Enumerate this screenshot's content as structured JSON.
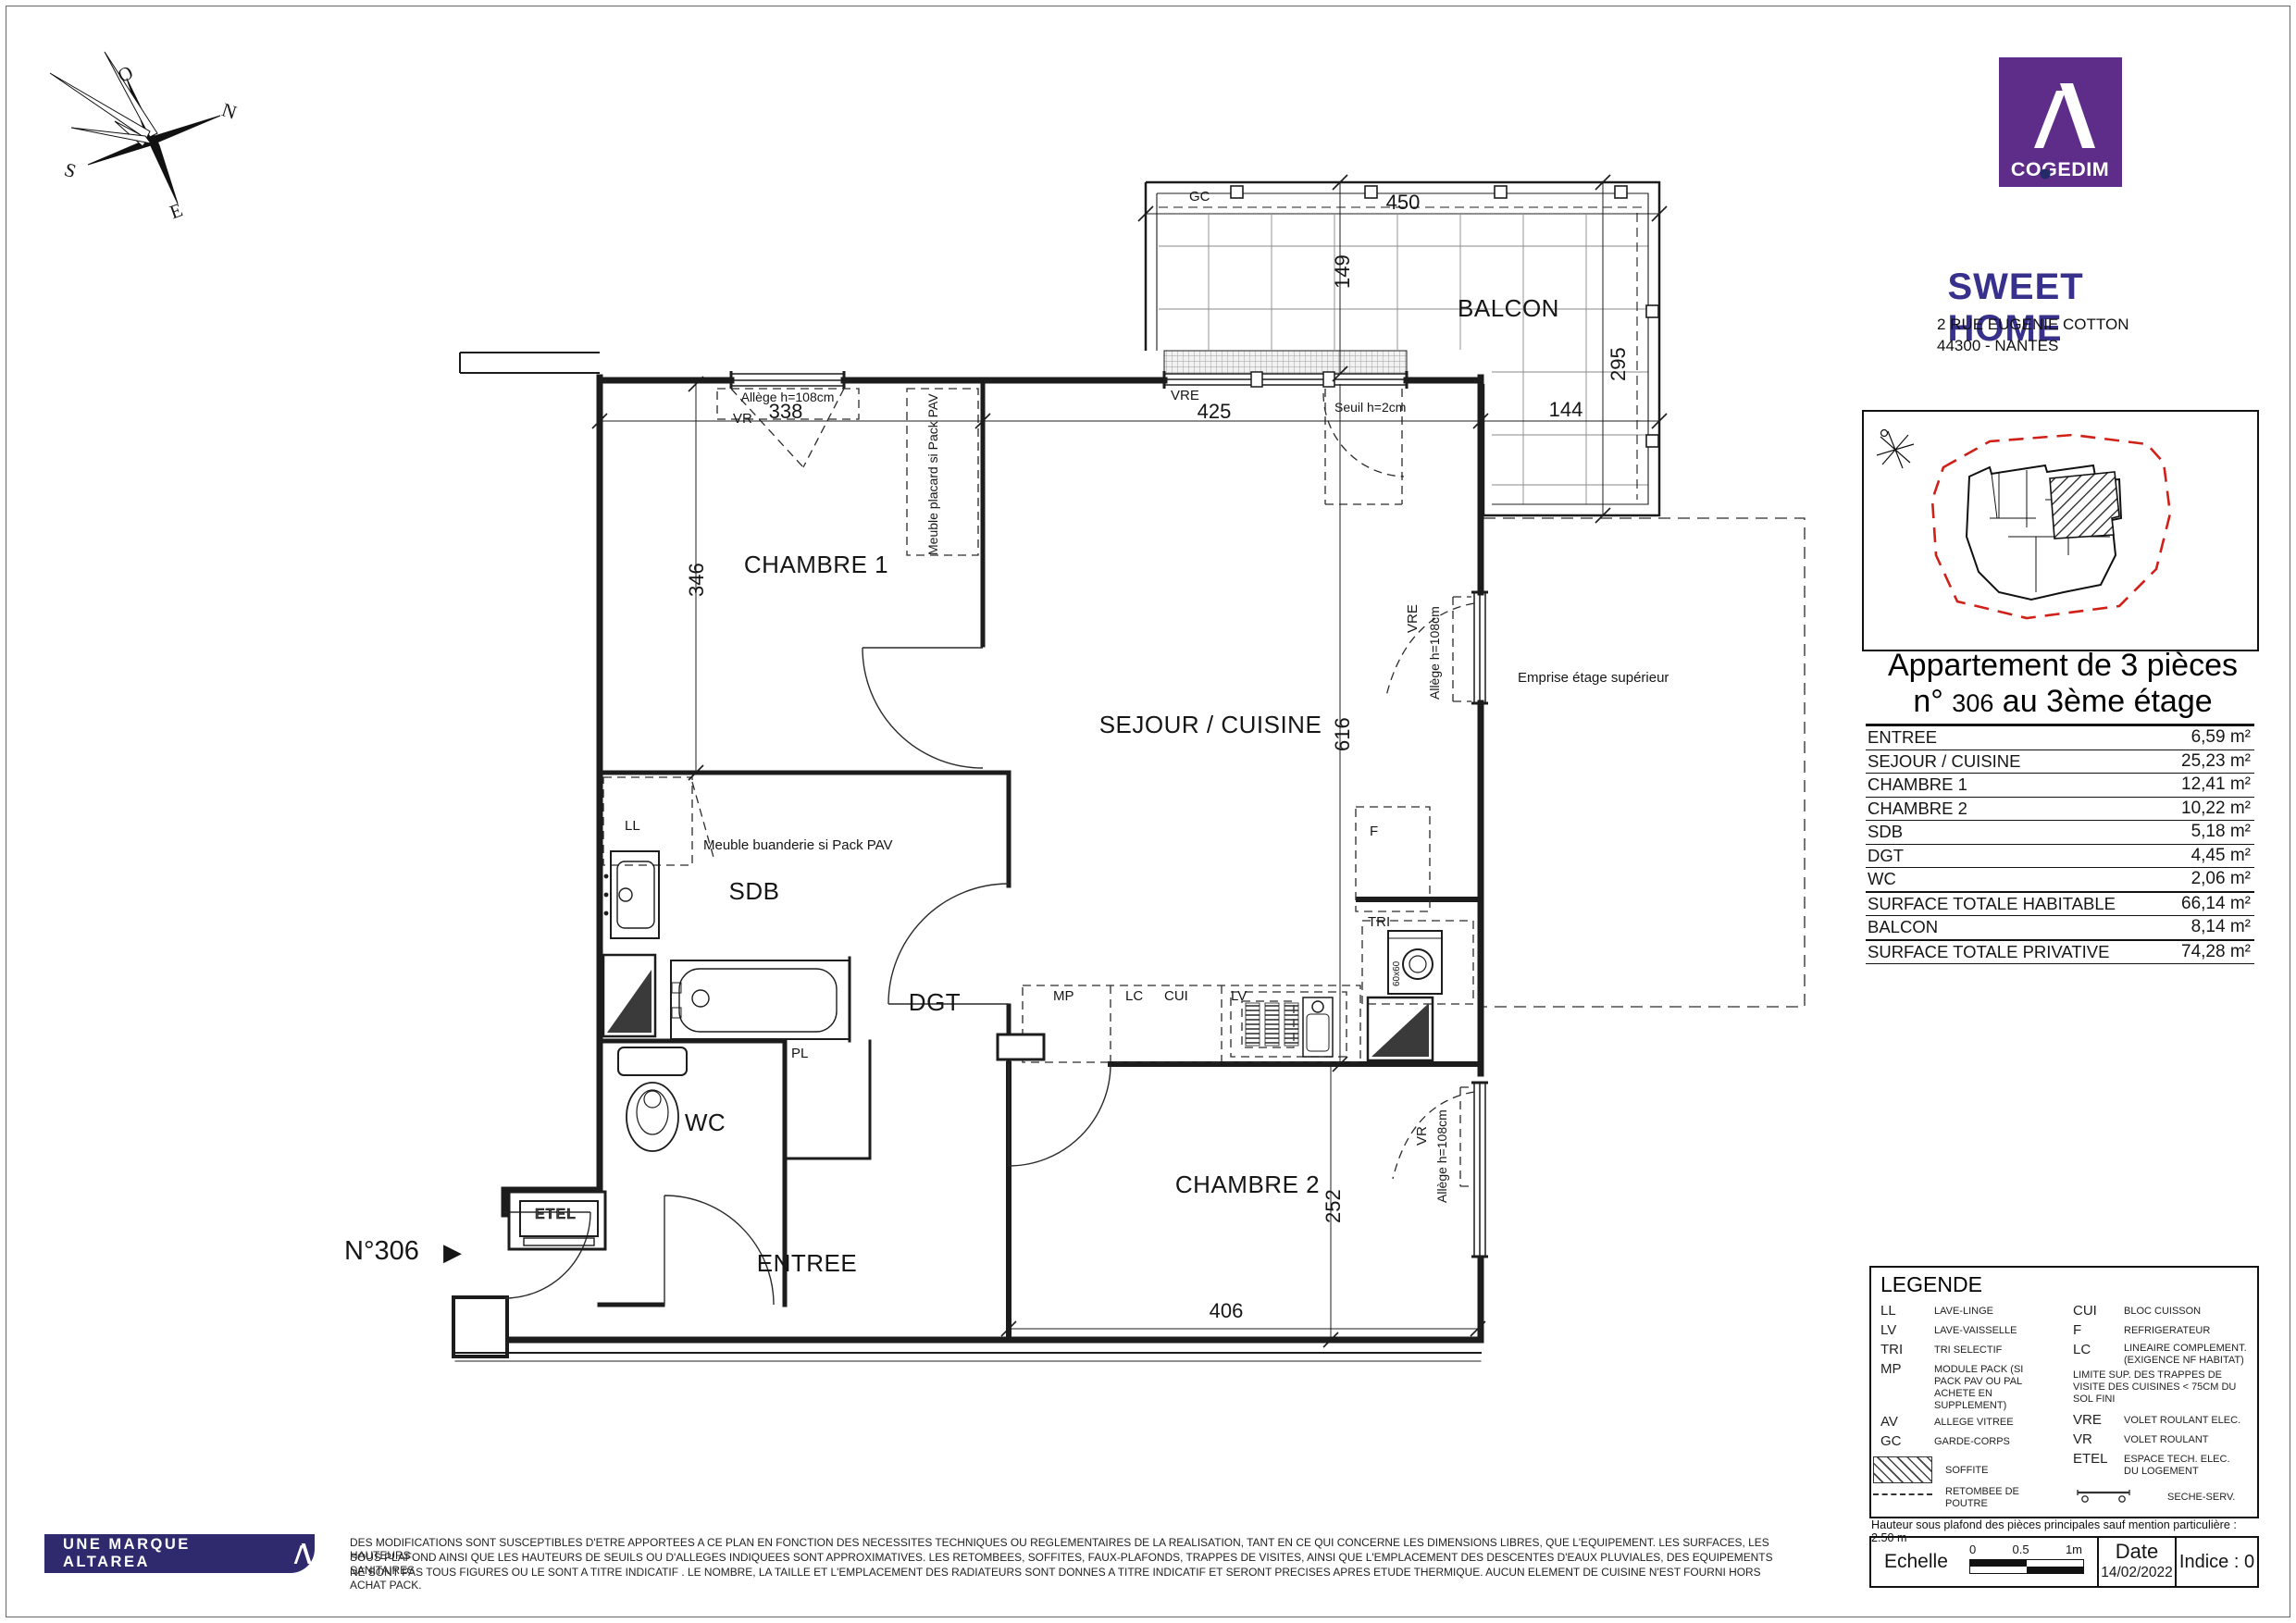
{
  "header": {
    "logo_brand": "COGEDIM",
    "residence": "SWEET HOME",
    "address1": "2 RUE EUGENIE COTTON",
    "address2": "44300 - NANTES"
  },
  "compass": {
    "o": "O",
    "n": "N",
    "s": "S",
    "e": "E"
  },
  "apartment": {
    "title_line1": "Appartement de 3 pièces",
    "num_prefix": "n°",
    "num": "306",
    "title_line2_rest": " au 3ème étage",
    "rows": [
      {
        "label": "ENTREE",
        "value": "6,59 m²"
      },
      {
        "label": "SEJOUR  / CUISINE",
        "value": "25,23 m²"
      },
      {
        "label": "CHAMBRE 1",
        "value": "12,41 m²"
      },
      {
        "label": "CHAMBRE 2",
        "value": "10,22 m²"
      },
      {
        "label": "SDB",
        "value": "5,18 m²"
      },
      {
        "label": "DGT",
        "value": "4,45 m²"
      },
      {
        "label": "WC",
        "value": "2,06 m²"
      },
      {
        "label": "SURFACE TOTALE HABITABLE",
        "value": "66,14 m²"
      },
      {
        "label": "BALCON",
        "value": "8,14 m²"
      },
      {
        "label": "SURFACE TOTALE PRIVATIVE",
        "value": "74,28 m²"
      }
    ]
  },
  "plan": {
    "rooms": {
      "balcon": "BALCON",
      "chambre1": "CHAMBRE 1",
      "sejour": "SEJOUR / CUISINE",
      "sdb": "SDB",
      "dgt": "DGT",
      "wc": "WC",
      "entree": "ENTREE",
      "chambre2": "CHAMBRE 2"
    },
    "dims": {
      "d450": "450",
      "d149": "149",
      "d295": "295",
      "d144": "144",
      "d425": "425",
      "d338": "338",
      "d346": "346",
      "d616": "616",
      "d252": "252",
      "d406": "406"
    },
    "ann": {
      "gc": "GC",
      "vre": "VRE",
      "vr": "VR",
      "seuil": "Seuil h=2cm",
      "allege": "Allège h=108cm",
      "emprise": "Emprise étage supérieur",
      "placard": "Meuble placard si Pack PAV",
      "buanderie": "Meuble buanderie si Pack PAV",
      "ll": "LL",
      "mp": "MP",
      "lc": "LC",
      "cui": "CUI",
      "lv": "LV",
      "f": "F",
      "tri": "TRI",
      "pl": "PL",
      "etel": "ETEL",
      "unit": "N°306",
      "unit_arrow": "▶",
      "oven": "60x60"
    }
  },
  "legend": {
    "title": "LEGENDE",
    "left": [
      {
        "abbr": "LL",
        "def": "LAVE-LINGE"
      },
      {
        "abbr": "LV",
        "def": "LAVE-VAISSELLE"
      },
      {
        "abbr": "TRI",
        "def": "TRI SELECTIF"
      },
      {
        "abbr": "MP",
        "def": "MODULE PACK (SI PACK PAV OU PAL ACHETE EN SUPPLEMENT)"
      },
      {
        "abbr": "AV",
        "def": "ALLEGE VITREE"
      },
      {
        "abbr": "GC",
        "def": "GARDE-CORPS"
      }
    ],
    "soffite": "SOFFITE",
    "retombee": "RETOMBEE DE POUTRE",
    "right": [
      {
        "abbr": "CUI",
        "def": "BLOC CUISSON"
      },
      {
        "abbr": "F",
        "def": "REFRIGERATEUR"
      },
      {
        "abbr": "LC",
        "def": "LINEAIRE COMPLEMENT. (EXIGENCE NF HABITAT)"
      }
    ],
    "note": "LIMITE SUP. DES TRAPPES DE VISITE DES CUISINES < 75CM DU SOL FINI",
    "right2": [
      {
        "abbr": "VRE",
        "def": "VOLET ROULANT ELEC."
      },
      {
        "abbr": "VR",
        "def": "VOLET ROULANT"
      },
      {
        "abbr": "ETEL",
        "def": "ESPACE TECH. ELEC. DU LOGEMENT"
      }
    ],
    "seche": "SECHE-SERV."
  },
  "footer": {
    "ceiling_note": "Hauteur sous plafond des pièces principales sauf mention particulière : 2.50 m",
    "scale_label": "Echelle",
    "scale_0": "0",
    "scale_05": "0.5",
    "scale_1m": "1m",
    "date_label": "Date",
    "date_value": "14/02/2022",
    "indice": "Indice : 0"
  },
  "brand_bar": {
    "text": "UNE MARQUE ALTAREA"
  },
  "disclaimer": {
    "line1": "DES MODIFICATIONS SONT SUSCEPTIBLES D'ETRE APPORTEES A CE PLAN EN FONCTION DES NECESSITES TECHNIQUES OU REGLEMENTAIRES DE LA REALISATION, TANT EN CE QUI CONCERNE LES DIMENSIONS LIBRES, QUE L'EQUIPEMENT. LES SURFACES, LES HAUTEURS",
    "line2": "SOUS PLAFOND AINSI QUE LES HAUTEURS DE SEUILS OU D'ALLEGES INDIQUEES SONT APPROXIMATIVES. LES RETOMBEES, SOFFITES, FAUX-PLAFONDS, TRAPPES DE VISITES, AINSI QUE L'EMPLACEMENT DES DESCENTES D'EAUX PLUVIALES, DES EQUIPEMENTS SANITAIRES",
    "line3": "NE SONT PAS TOUS FIGURES OU LE SONT A TITRE INDICATIF . LE NOMBRE, LA TAILLE ET L'EMPLACEMENT DES RADIATEURS SONT DONNES A TITRE INDICATIF ET SERONT PRECISES APRES ETUDE THERMIQUE. AUCUN ELEMENT DE CUISINE N'EST FOURNI HORS ACHAT PACK."
  },
  "colors": {
    "cogedim_purple": "#5E2D8A",
    "title_blue": "#37318C",
    "altarea_blue": "#2E2A6D",
    "keyplan_red": "#D02018"
  }
}
